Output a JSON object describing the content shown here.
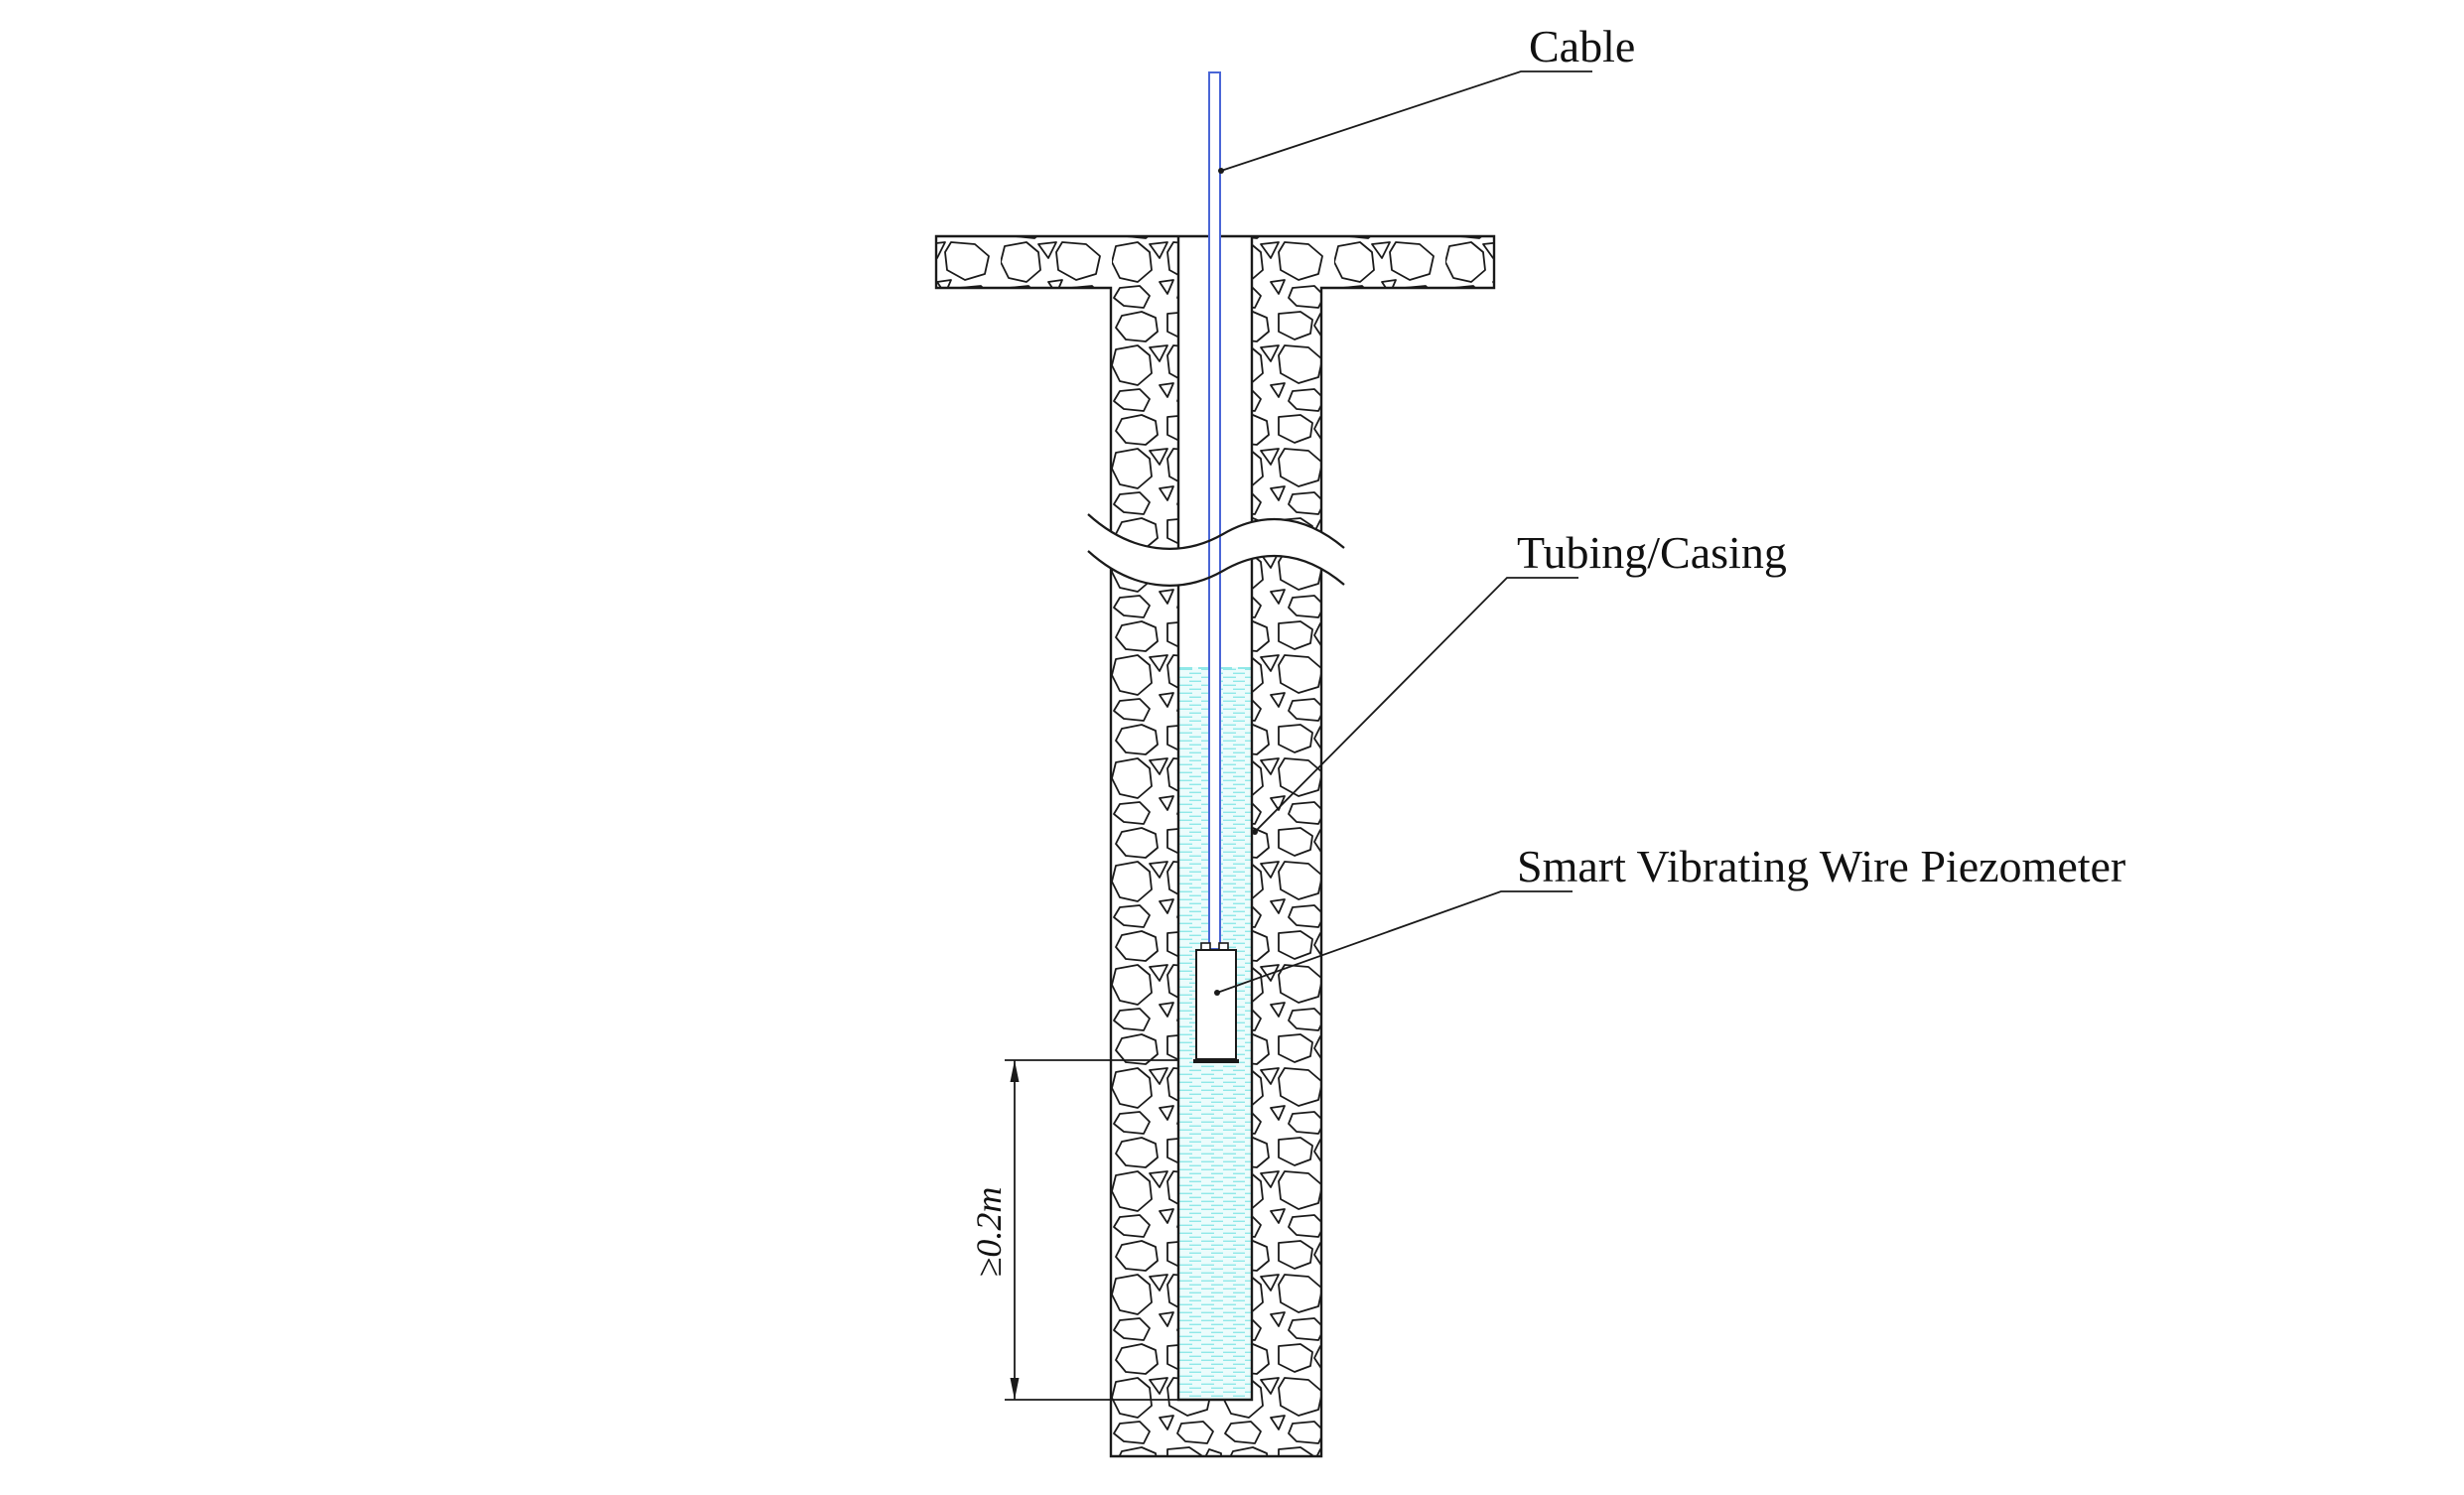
{
  "diagram": {
    "title": "Smart Vibrating Wire Piezometer borehole installation diagram",
    "labels": {
      "cable": "Cable",
      "tubing_casing": "Tubing/Casing",
      "piezometer": "Smart Vibrating Wire Piezometer"
    },
    "dimension": {
      "value": "≥0.2m"
    },
    "colors": {
      "cable_blue": "#4a66d6",
      "water_dash": "#8fe8e8",
      "water_bg": "#ecfcfc",
      "line_black": "#1a1a1a"
    }
  }
}
